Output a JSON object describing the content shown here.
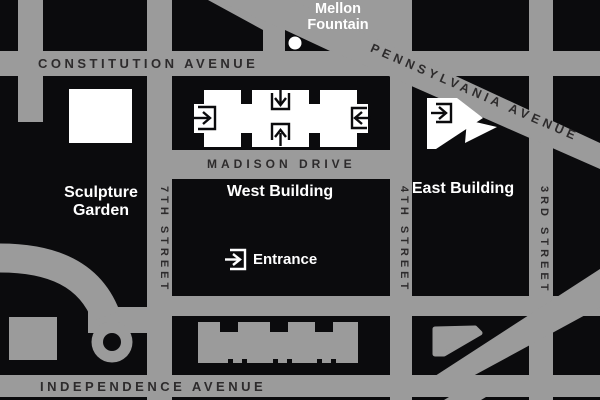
{
  "map": {
    "streets": {
      "constitution": "CONSTITUTION AVENUE",
      "pennsylvania": "PENNSYLVANIA AVENUE",
      "madison": "MADISON DRIVE",
      "independence": "INDEPENDENCE AVENUE",
      "seventh": "7TH STREET",
      "fourth": "4TH STREET",
      "third": "3RD STREET"
    },
    "labels": {
      "mellon_fountain": "Mellon Fountain",
      "sculpture_garden": "Sculpture Garden",
      "west_building": "West Building",
      "east_building": "East Building",
      "entrance": "Entrance"
    },
    "icons": {
      "entrance_icon_meaning": "arrow-into-doorway entrance marker"
    },
    "colors": {
      "background": "#0b0b0d",
      "road_gray": "#9b9b9b",
      "building_white": "#ffffff",
      "dark_label": "#2d2b2c"
    }
  }
}
